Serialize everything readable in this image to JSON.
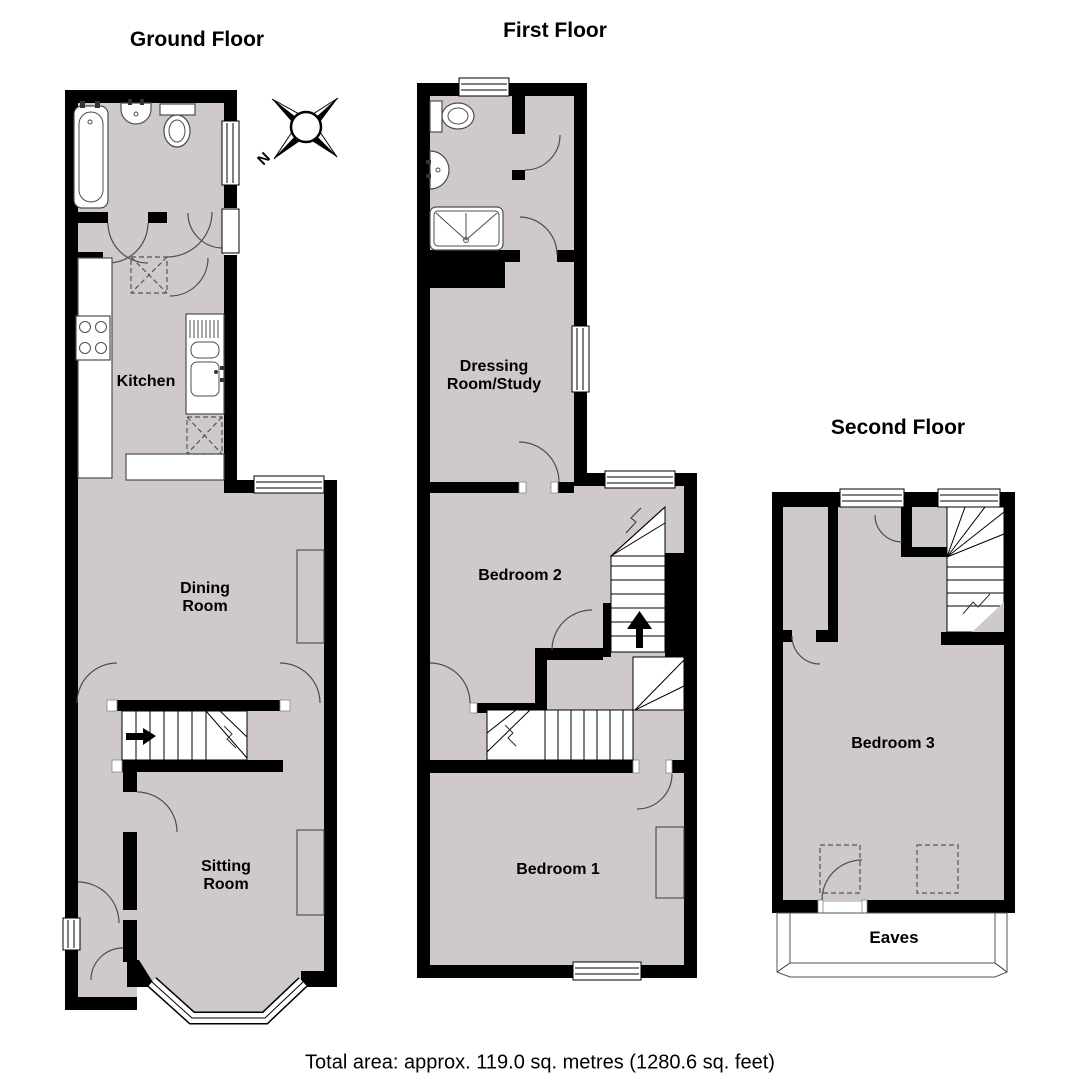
{
  "page": {
    "background": "#ffffff"
  },
  "colors": {
    "floor_fill": "#d0c9c9",
    "wall": "#000000",
    "fixture_outline": "#4d4d4d"
  },
  "plan": {
    "floors": [
      {
        "title": "Ground Floor",
        "rooms": [
          "Kitchen",
          "Dining Room",
          "Sitting Room"
        ],
        "features": [
          "bathroom",
          "entrance-hall",
          "staircase",
          "bay-window"
        ]
      },
      {
        "title": "First Floor",
        "rooms": [
          "Dressing Room/Study",
          "Bedroom 2",
          "Bedroom 1"
        ],
        "features": [
          "shower-room",
          "staircase",
          "landing"
        ]
      },
      {
        "title": "Second Floor",
        "rooms": [
          "Bedroom 3",
          "Eaves"
        ],
        "features": [
          "staircase",
          "eaves-storage"
        ]
      }
    ],
    "compass": {
      "north_label": "N"
    },
    "labels": {
      "ground_title": "Ground Floor",
      "first_title": "First Floor",
      "second_title": "Second Floor",
      "kitchen": "Kitchen",
      "dining_room": "Dining\nRoom",
      "sitting_room": "Sitting\nRoom",
      "dressing_room": "Dressing\nRoom/Study",
      "bedroom2": "Bedroom 2",
      "bedroom1": "Bedroom 1",
      "bedroom3": "Bedroom 3",
      "eaves": "Eaves",
      "north": "N"
    }
  },
  "footer": {
    "total_area": "Total area: approx. 119.0 sq. metres (1280.6 sq. feet)"
  }
}
